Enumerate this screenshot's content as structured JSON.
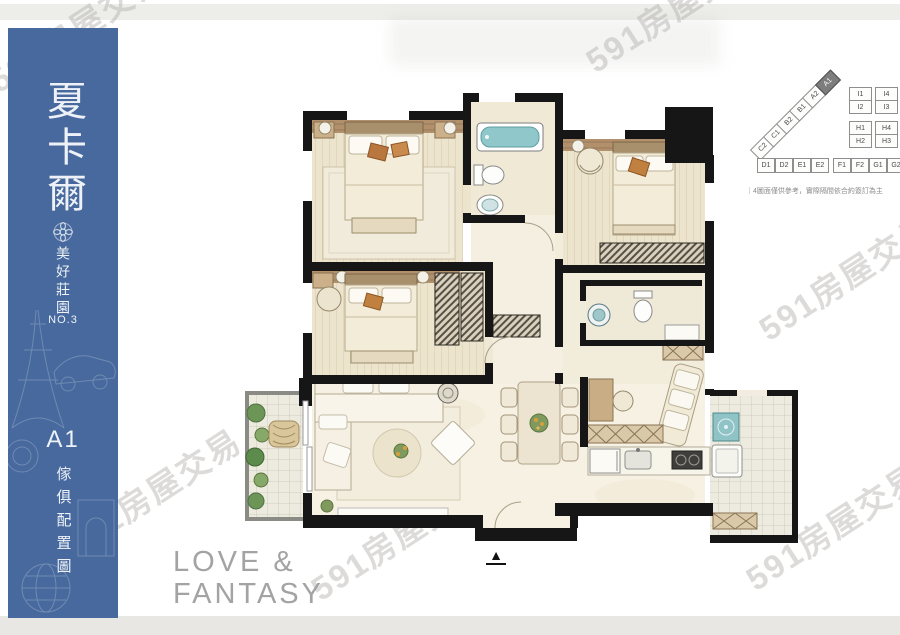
{
  "watermark": {
    "text": "591房屋交易"
  },
  "colors": {
    "sidebar_blue": "#47699d",
    "wall_black": "#161616",
    "fixture_teal": "#8fc7ca",
    "slogan_gray": "#a3a3a3"
  },
  "sidebar": {
    "title": "夏卡爾",
    "subtitle": "美好莊園",
    "series_no": "NO.3",
    "unit_label": "A1",
    "drawing_type": "傢俱配置圖"
  },
  "keyplan": {
    "diagonal_units": [
      "C2",
      "C1",
      "B2",
      "B1",
      "A2",
      "A1"
    ],
    "highlighted_unit": "A1",
    "stacks": [
      [
        "I1",
        "I2"
      ],
      [
        "I4",
        "I3"
      ],
      [
        "H1",
        "H2"
      ],
      [
        "H4",
        "H3"
      ]
    ],
    "bottom_row": [
      "D1",
      "D2",
      "E1",
      "E2",
      "F1",
      "F2",
      "G1",
      "G2"
    ],
    "caption": "｜4圖面僅供參考，實際隔間依合約簽訂為主"
  },
  "plan": {
    "north_arrow": "▲"
  },
  "slogan": {
    "line1": "LOVE &",
    "line2": "FANTASY"
  }
}
